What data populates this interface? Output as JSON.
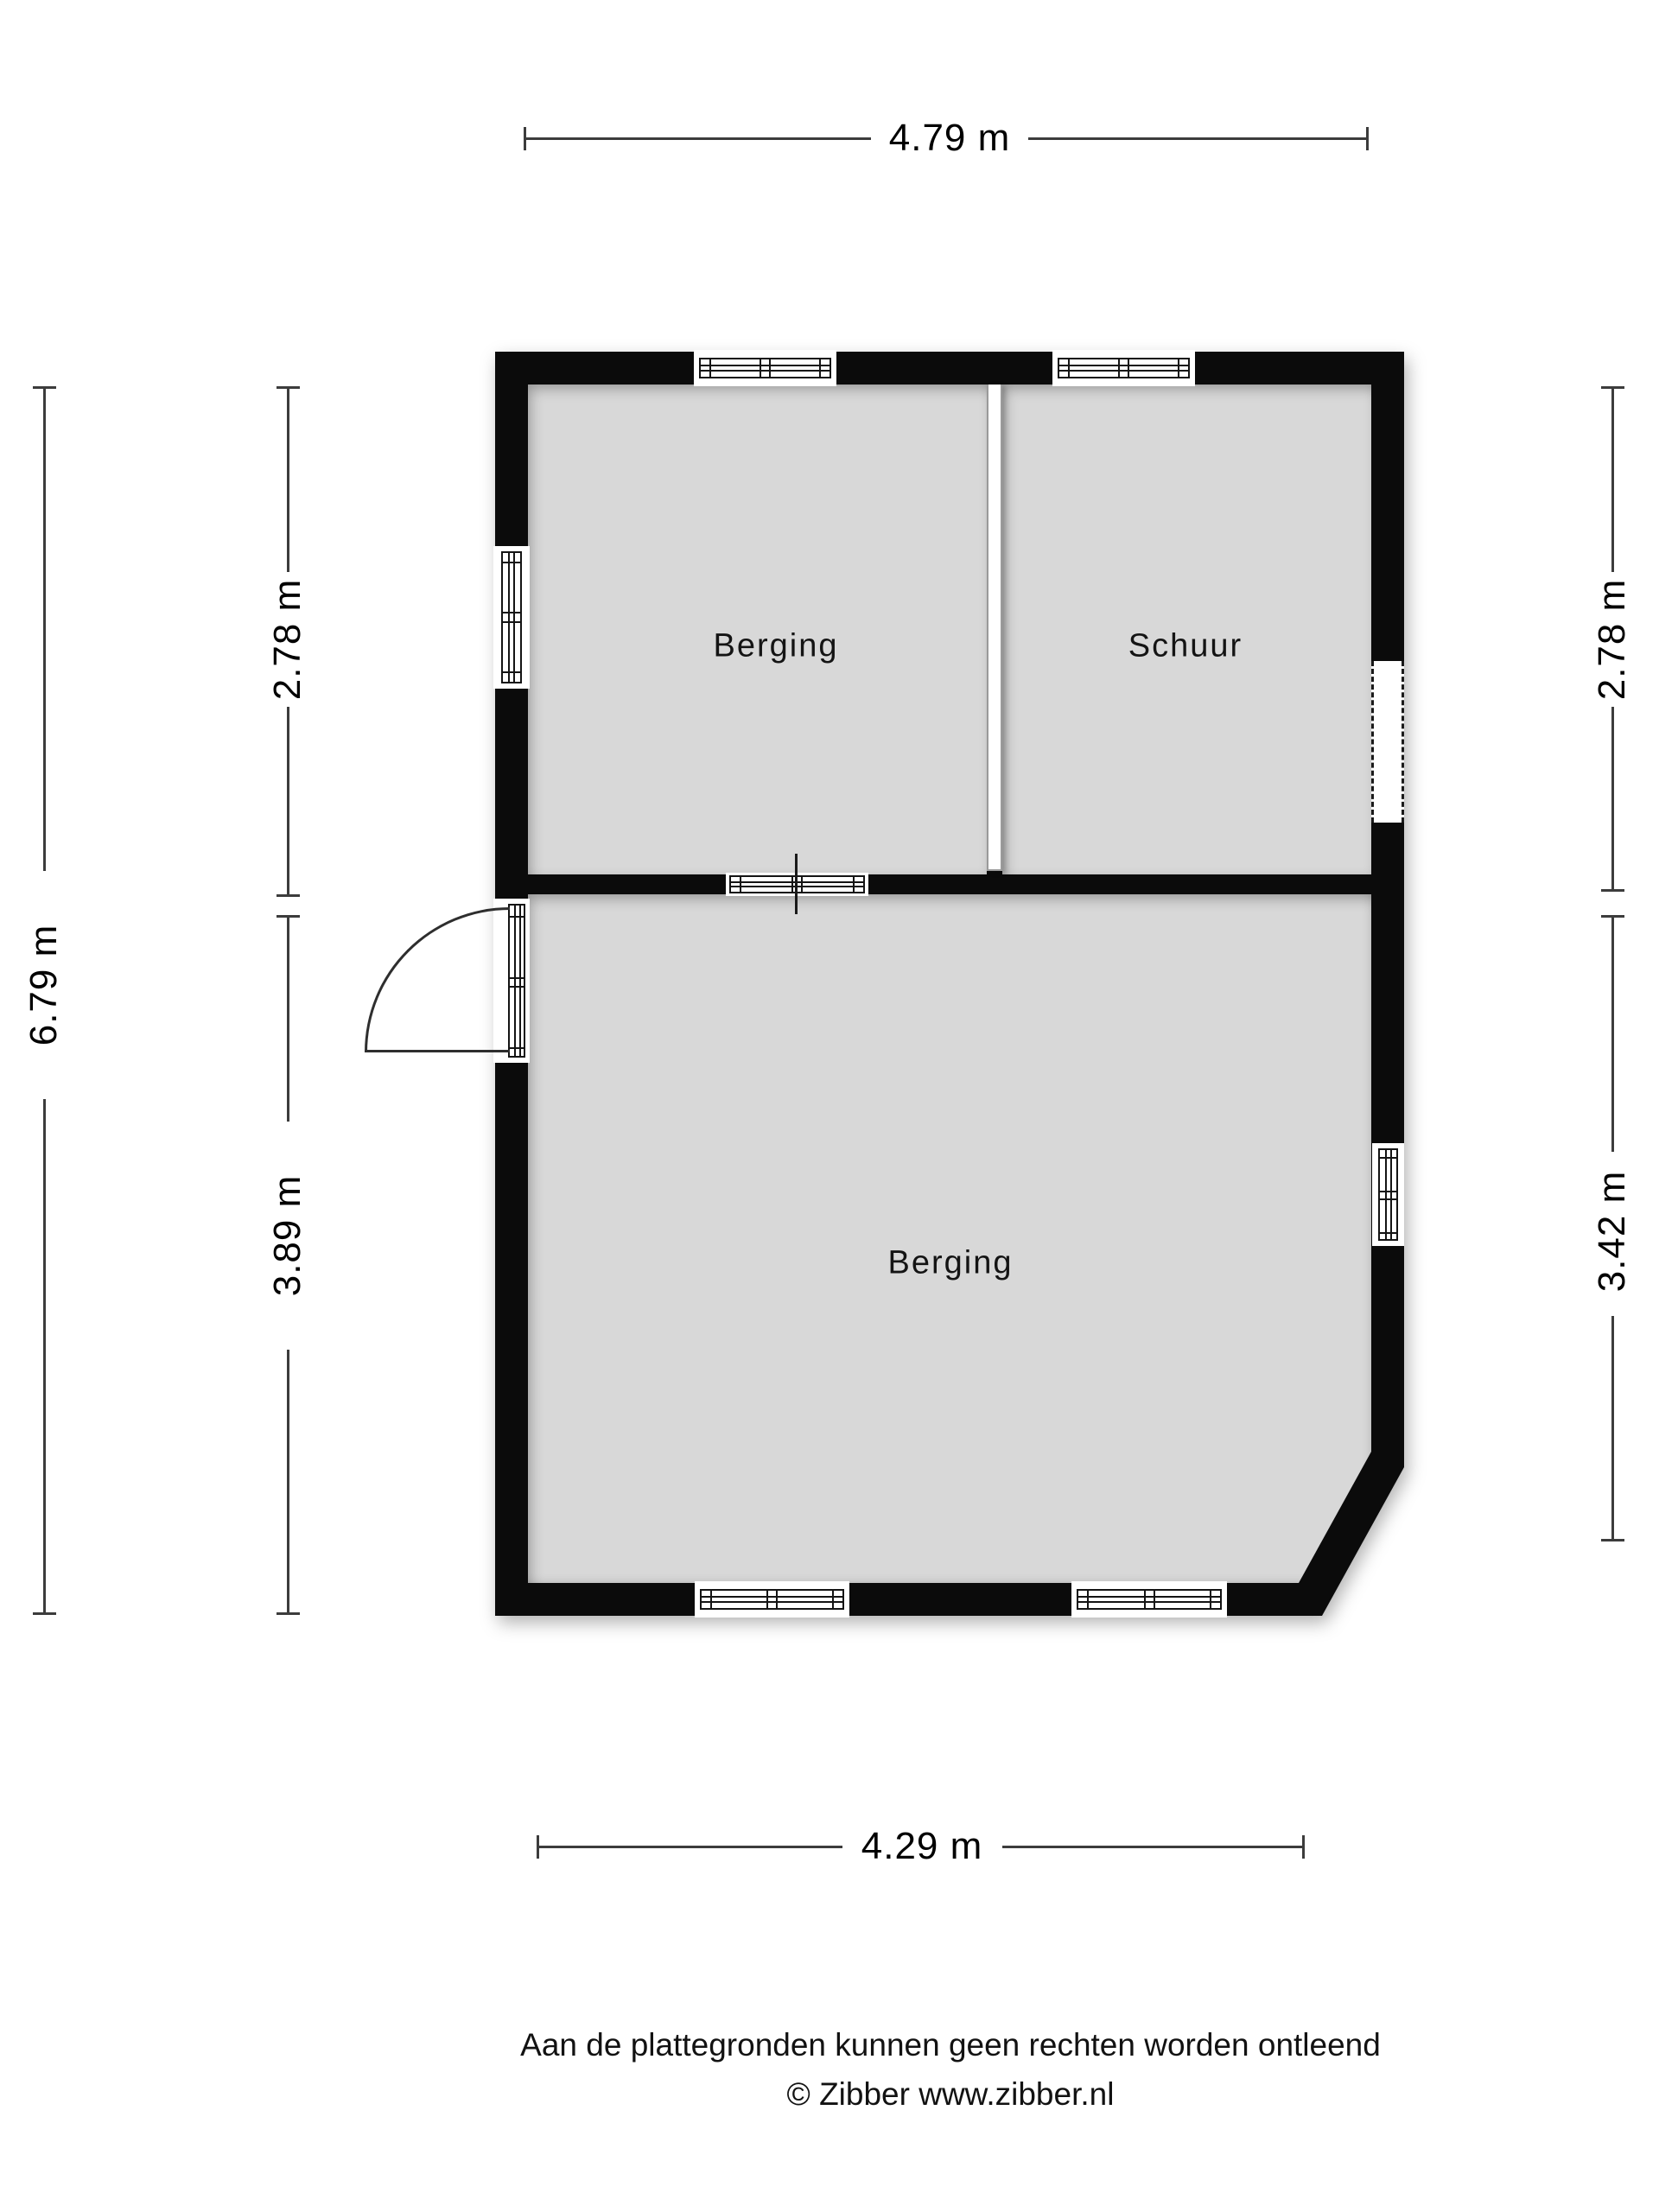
{
  "floor_plan": {
    "rooms": [
      {
        "id": "berging-top",
        "label": "Berging"
      },
      {
        "id": "schuur",
        "label": "Schuur"
      },
      {
        "id": "berging-bottom",
        "label": "Berging"
      }
    ],
    "dimensions": {
      "top_width": "4.79 m",
      "bottom_width": "4.29 m",
      "left_total_height": "6.79 m",
      "left_upper_height": "2.78 m",
      "left_lower_height": "3.89 m",
      "right_upper_height": "2.78 m",
      "right_lower_height": "3.42 m"
    },
    "colors": {
      "wall": "#0b0b0b",
      "floor": "#d8d8d8",
      "dimension_line": "#3c3c3c",
      "partition_outline": "#9a9a9a",
      "background": "#ffffff"
    }
  },
  "footer": {
    "disclaimer": "Aan de plattegronden kunnen geen rechten worden ontleend",
    "credit": "© Zibber www.zibber.nl"
  }
}
